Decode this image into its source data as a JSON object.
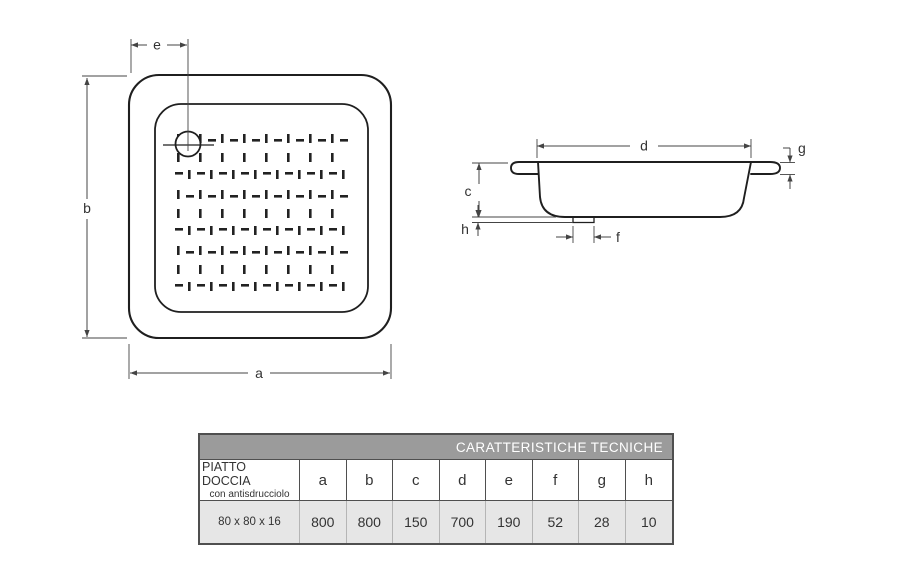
{
  "colors": {
    "page_bg": "#ffffff",
    "line": "#1f1f1f",
    "dim": "#444444",
    "text": "#333333",
    "header_bg": "#9b9b9b",
    "header_text": "#ffffff",
    "values_row_bg": "#e6e6e6",
    "table_border": "#4f4f4f",
    "row3_divider": "#b5b5b5"
  },
  "drawing": {
    "dims": {
      "a": "a",
      "b": "b",
      "c": "c",
      "d": "d",
      "e": "e",
      "f": "f",
      "g": "g",
      "h": "h"
    }
  },
  "table": {
    "title": "CARATTERISTICHE TECNICHE",
    "product_line1": "PIATTO DOCCIA",
    "product_line2": "con antisdrucciolo",
    "size": "80 x 80 x 16",
    "columns": [
      "a",
      "b",
      "c",
      "d",
      "e",
      "f",
      "g",
      "h"
    ],
    "values": [
      "800",
      "800",
      "150",
      "700",
      "190",
      "52",
      "28",
      "10"
    ]
  }
}
